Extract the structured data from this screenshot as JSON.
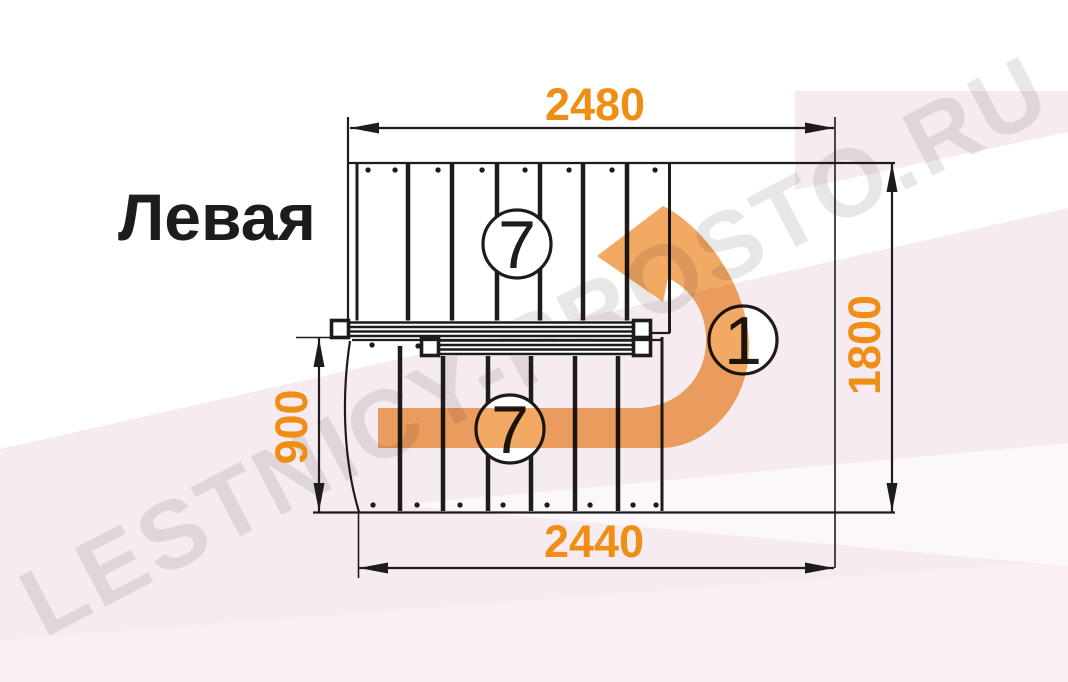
{
  "title": "Левая",
  "watermark": "LESTNICY-PROSTO.RU",
  "dimensions": {
    "top": "2480",
    "bottom": "2440",
    "right": "1800",
    "left": "900"
  },
  "flights": {
    "upper_steps": "7",
    "lower_steps": "7",
    "turn_steps": "1"
  },
  "colors": {
    "ink": "#1d1c1a",
    "dimension_text": "#ef8e15",
    "arrow": "#f0a052",
    "background_pink": "#f7ebf2",
    "watermark": "#70616c"
  }
}
